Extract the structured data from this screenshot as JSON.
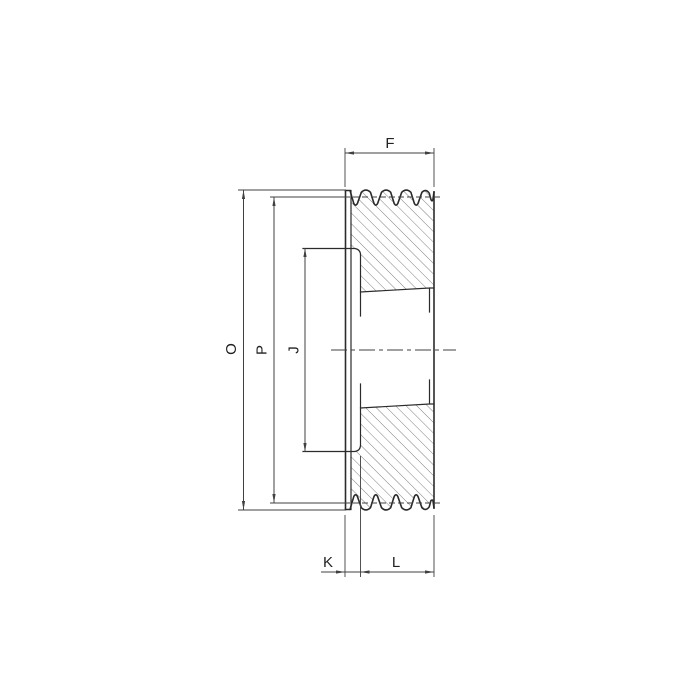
{
  "labels": {
    "F": "F",
    "O": "O",
    "P": "P",
    "J": "J",
    "K": "K",
    "L": "L"
  },
  "colors": {
    "background": "#ffffff",
    "outline": "#2b2b2b",
    "dimension": "#404040",
    "hatch": "#707070",
    "text": "#222222"
  }
}
